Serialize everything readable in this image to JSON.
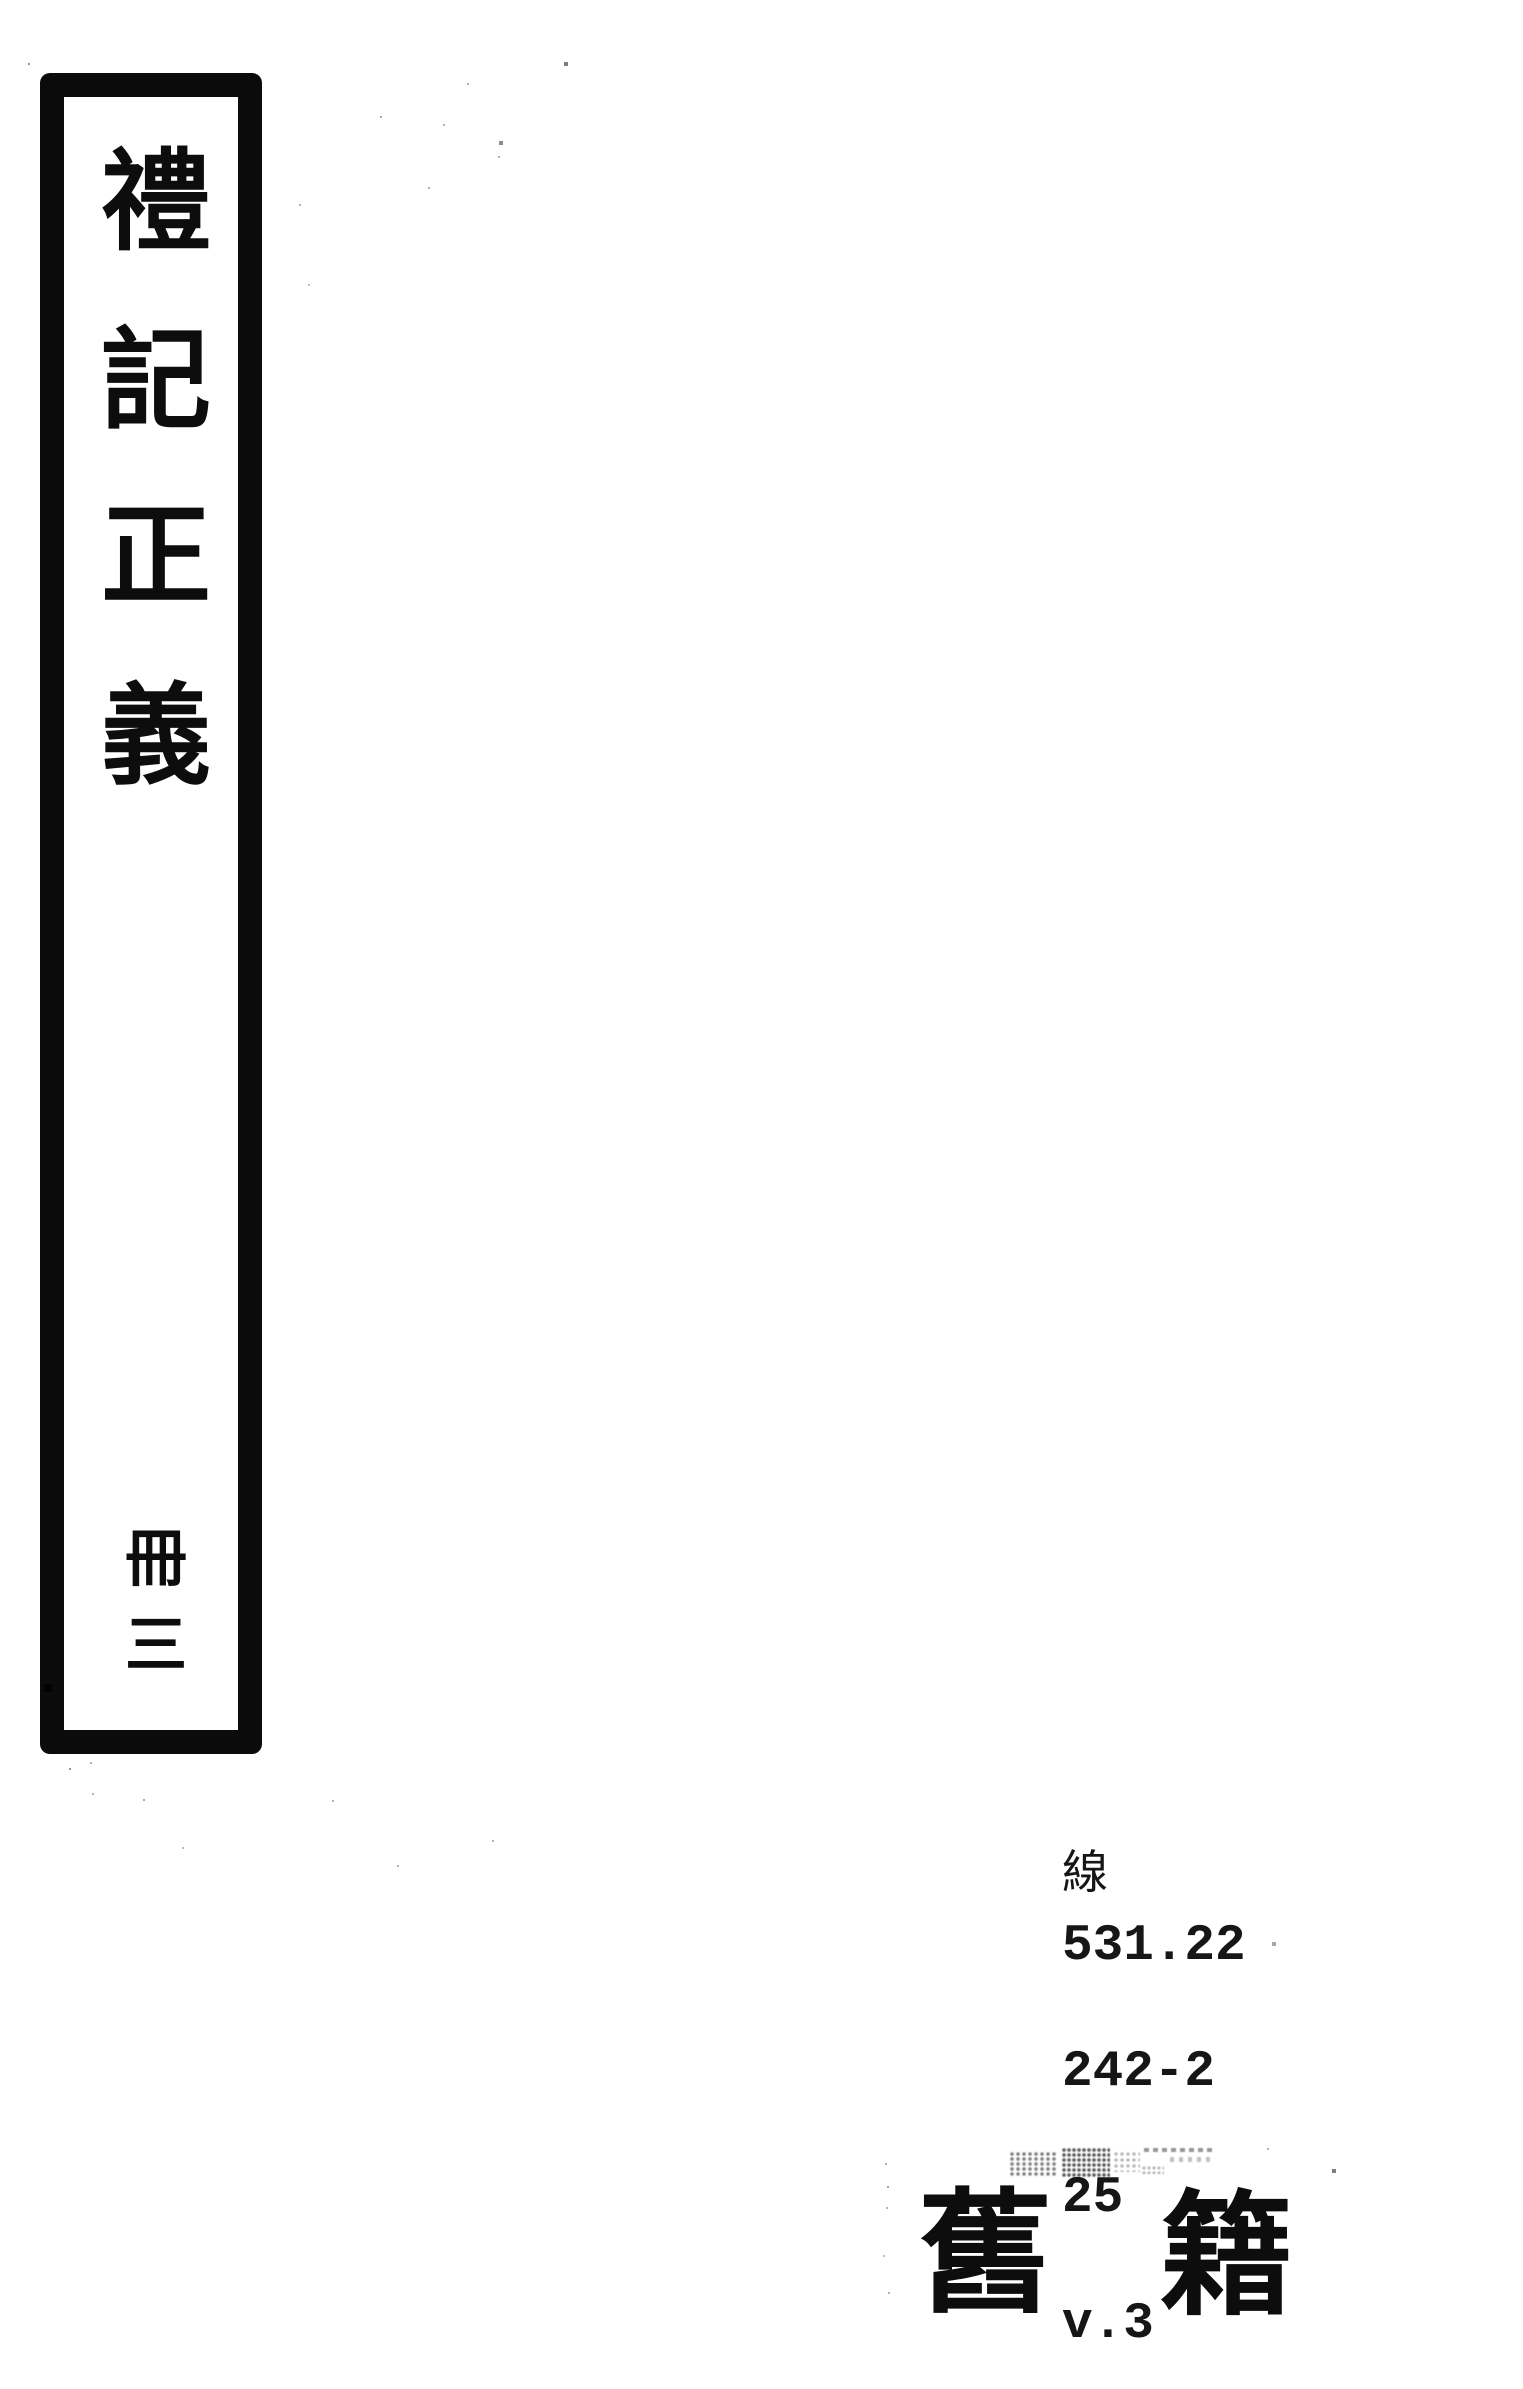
{
  "spine": {
    "title": "禮記正義",
    "title_chars": [
      "禮",
      "記",
      "正",
      "義"
    ],
    "volume": "冊三",
    "volume_chars": [
      "冊",
      "三"
    ]
  },
  "call_number": {
    "class_prefix": "線",
    "lines": [
      "531.22",
      "242-2",
      "25",
      "v.3"
    ]
  },
  "stamp": {
    "text": "舊籍",
    "chars": [
      "舊",
      "籍"
    ]
  },
  "colors": {
    "ink": "#0d0d0d",
    "paper": "#ffffff"
  }
}
